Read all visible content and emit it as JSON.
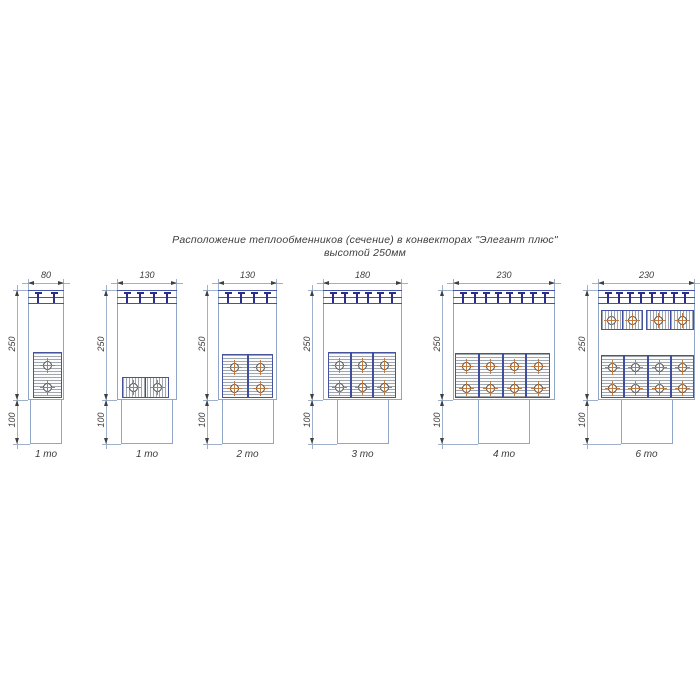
{
  "title": {
    "line1": "Расположение теплообменников (сечение) в конвекторах \"Элегант плюс\"",
    "line2": "высотой 250мм"
  },
  "colors": {
    "body_stroke": "#8fa6c6",
    "grille_stroke": "#4553a5",
    "tee": "#2b2d8a",
    "hatch_line": "#a0a6ad",
    "hatch_bg": "#fbfbfb",
    "block_border": "#46549f",
    "divider": "#3f4d9e",
    "dim_line": "#9db1cc",
    "arrow": "#3f3f3f",
    "text": "#3c3c3c",
    "tube_stroke": "#4a4a4a",
    "tube_cross": "#bf7a3f"
  },
  "diagrams": [
    {
      "label": "1 то",
      "width_mm": "80",
      "height_mm": "250",
      "depth_mm": "100",
      "cx": 46,
      "body_w": 36,
      "tees": 2,
      "duct_w": 32,
      "blocks": [
        {
          "orient": "v",
          "x": 33,
          "y": 352,
          "w": 29,
          "h": 46,
          "cols": 1
        }
      ]
    },
    {
      "label": "1 то",
      "width_mm": "130",
      "height_mm": "250",
      "depth_mm": "100",
      "cx": 147,
      "body_w": 60,
      "tees": 4,
      "duct_w": 52,
      "blocks": [
        {
          "orient": "h",
          "x": 122,
          "y": 377,
          "w": 47,
          "h": 21,
          "cells": 2
        }
      ]
    },
    {
      "label": "2 то",
      "width_mm": "130",
      "height_mm": "250",
      "depth_mm": "100",
      "cx": 247.5,
      "body_w": 59,
      "tees": 4,
      "duct_w": 52,
      "blocks": [
        {
          "orient": "v",
          "x": 222,
          "y": 354,
          "w": 51,
          "h": 44,
          "cols": 2
        }
      ]
    },
    {
      "label": "3 то",
      "width_mm": "180",
      "height_mm": "250",
      "depth_mm": "100",
      "cx": 362.5,
      "body_w": 79,
      "tees": 6,
      "duct_w": 52,
      "blocks": [
        {
          "orient": "v",
          "x": 328,
          "y": 352,
          "w": 68,
          "h": 46,
          "cols": 3
        }
      ]
    },
    {
      "label": "4 то",
      "width_mm": "230",
      "height_mm": "250",
      "depth_mm": "100",
      "cx": 504,
      "body_w": 102,
      "tees": 8,
      "duct_w": 52,
      "blocks": [
        {
          "orient": "v",
          "x": 455,
          "y": 353,
          "w": 95,
          "h": 45,
          "cols": 4
        }
      ]
    },
    {
      "label": "6 то",
      "width_mm": "230",
      "height_mm": "250",
      "depth_mm": "100",
      "cx": 646.5,
      "body_w": 97,
      "tees": 8,
      "duct_w": 52,
      "blocks": [
        {
          "orient": "h",
          "x": 601,
          "y": 310,
          "w": 42,
          "h": 20,
          "cells": 2
        },
        {
          "orient": "h",
          "x": 646,
          "y": 310,
          "w": 48,
          "h": 20,
          "cells": 2
        },
        {
          "orient": "v",
          "x": 601,
          "y": 355,
          "w": 93,
          "h": 43,
          "cols": 4
        }
      ]
    }
  ]
}
